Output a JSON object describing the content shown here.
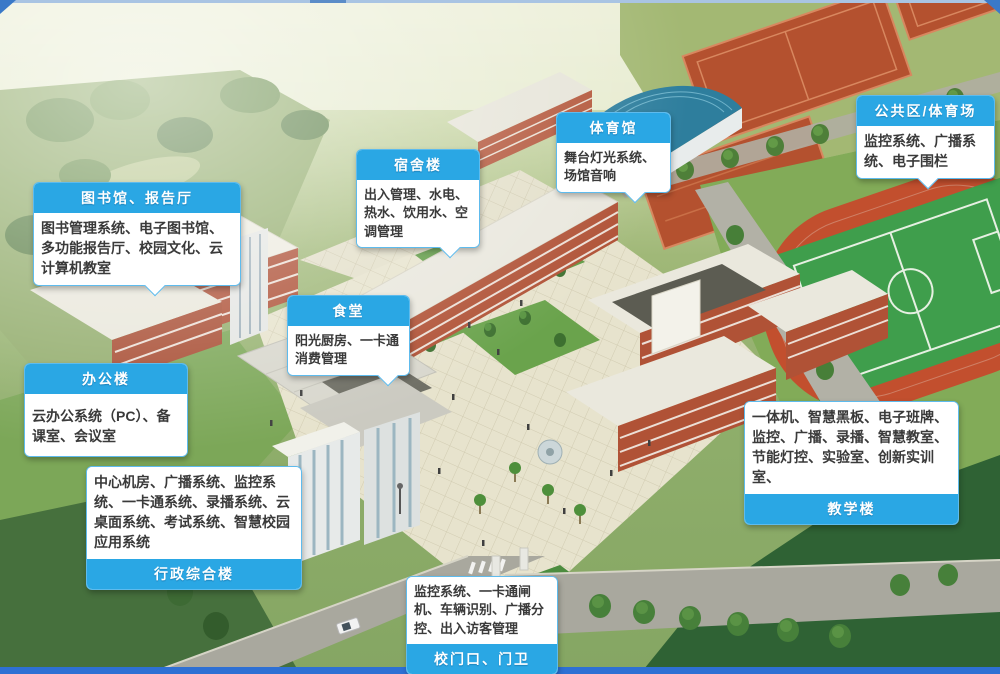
{
  "colors": {
    "label_header_bg": "#2aa7e4",
    "label_header_text": "#ffffff",
    "label_border": "#5ebbed",
    "label_body_bg": "#ffffff",
    "label_body_text": "#3a3a3a",
    "footer_bar": "#2e70d4",
    "top_line": "#a9c4e3"
  },
  "callouts": [
    {
      "id": "library-hall",
      "title": "图书馆、报告厅",
      "body": "图书管理系统、电子图书馆、多功能报告厅、校园文化、云计算机教室",
      "header_side": "top"
    },
    {
      "id": "dormitory",
      "title": "宿舍楼",
      "body": "出入管理、水电、热水、饮用水、空调管理",
      "header_side": "top"
    },
    {
      "id": "gymnasium",
      "title": "体育馆",
      "body": "舞台灯光系统、场馆音响",
      "header_side": "top"
    },
    {
      "id": "public-stadium",
      "title": "公共区/体育场",
      "body": "监控系统、广播系统、电子围栏",
      "header_side": "top"
    },
    {
      "id": "canteen",
      "title": "食堂",
      "body": "阳光厨房、一卡通消费管理",
      "header_side": "top"
    },
    {
      "id": "office",
      "title": "办公楼",
      "body": "云办公系统（PC）、备课室、会议室",
      "header_side": "top"
    },
    {
      "id": "admin-complex",
      "title": "行政综合楼",
      "body": "中心机房、广播系统、监控系统、一卡通系统、录播系统、云桌面系统、考试系统、智慧校园应用系统",
      "header_side": "bottom"
    },
    {
      "id": "teaching",
      "title": "教学楼",
      "body": "一体机、智慧黑板、电子班牌、监控、广播、录播、智慧教室、节能灯控、实验室、创新实训室、",
      "header_side": "bottom"
    },
    {
      "id": "gate-guard",
      "title": "校门口、门卫",
      "body": "监控系统、一卡通闸机、车辆识别、广播分控、出入访客管理",
      "header_side": "bottom"
    }
  ]
}
